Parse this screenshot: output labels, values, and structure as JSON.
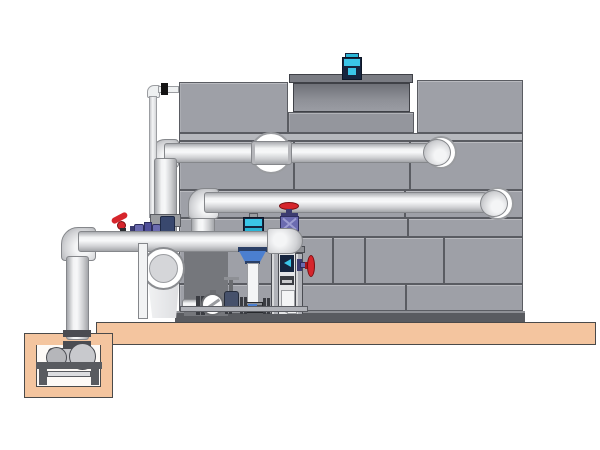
{
  "diagram": {
    "type": "technical-illustration",
    "subject": "closed-circuit cooling tower with pump skid, suction header and sump pump",
    "visible_text": [],
    "components": [
      {
        "id": "cooling-tower-structure",
        "label": "paneled cooling tower casing"
      },
      {
        "id": "fan-cowl",
        "label": "fan cowl on tower roof"
      },
      {
        "id": "fan-motor",
        "label": "cyan fan motor"
      },
      {
        "id": "upper-return-pipe",
        "label": "upper horizontal return pipe with wall sleeve"
      },
      {
        "id": "mid-return-pipe",
        "label": "middle horizontal return pipe with wall sleeve"
      },
      {
        "id": "riser-pipe",
        "label": "vertical riser pipe at tower left"
      },
      {
        "id": "makeup-line",
        "label": "thin make-up water line"
      },
      {
        "id": "suction-header",
        "label": "lower suction header pipe"
      },
      {
        "id": "header-end-cap",
        "label": "bulbous header end cap on stand"
      },
      {
        "id": "globe-valve",
        "label": "red handwheel globe valve"
      },
      {
        "id": "side-valve",
        "label": "red handwheel side valve"
      },
      {
        "id": "lever-valve",
        "label": "small red lever valve"
      },
      {
        "id": "purple-valve-train",
        "label": "small purple valve assembly"
      },
      {
        "id": "instrument-stand",
        "label": "framed instrument stand with gauge"
      },
      {
        "id": "vertical-inline-pump",
        "label": "vertical inline pump with cyan motor and blue bowl"
      },
      {
        "id": "centrifugal-pump",
        "label": "end-suction pump with round inlet flange"
      },
      {
        "id": "check-valve",
        "label": "ball check valve"
      },
      {
        "id": "gate-valve",
        "label": "small gate valve"
      },
      {
        "id": "pump-skid",
        "label": "pump skid base"
      },
      {
        "id": "concrete-platform",
        "label": "tan equipment platform"
      },
      {
        "id": "sump-pit",
        "label": "tan sump pit"
      },
      {
        "id": "sump-pump",
        "label": "horizontal sump pump on stand"
      }
    ]
  },
  "colors": {
    "background": "#ffffff",
    "panel_gray": "#9ea0a7",
    "panel_line": "#5a5c62",
    "panel_rail": "#b6b8bd",
    "panel_recess": "#94969d",
    "shroud_dark": "#6f7178",
    "base_dark": "#595b60",
    "pipe_border": "#85878b",
    "motor_cyan": "#3bc6e8",
    "motor_cyan_bright": "#2ab5d6",
    "motor_navy": "#16253f",
    "valve_purple": "#6b6bb0",
    "valve_purple_dark": "#3c3c70",
    "valve_red": "#d6252c",
    "valve_red_dark": "#7a0e12",
    "pump_blue": "#4b7fd0",
    "pump_blue_dark": "#2a3f66",
    "platform_tan": "#f4c59f",
    "pit_interior": "#fdfaf7",
    "metal_dark": "#4a4c52",
    "metal_mid": "#b0b2b8",
    "backdrop_shadow": "#75777c",
    "white": "#ffffff"
  }
}
